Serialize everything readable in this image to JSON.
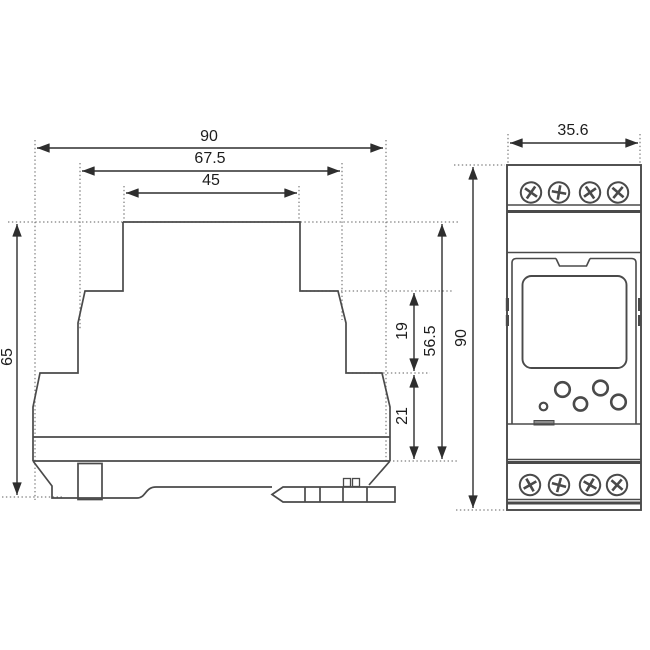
{
  "drawing": {
    "dimensions": {
      "side_view": {
        "total_width": "90",
        "upper_width": "67.5",
        "top_width": "45",
        "total_height": "65",
        "upper_step": "19",
        "body_height": "56.5",
        "lower_step": "21"
      },
      "front_view": {
        "width": "35.6",
        "height": "90"
      }
    },
    "colors": {
      "outline": "#4a4a4a",
      "dimension": "#2e2e2e",
      "extension": "#7e7e7e",
      "screw_fill": "#ffffff",
      "tab_fill": "#8c8c8c",
      "background": "#ffffff"
    }
  }
}
